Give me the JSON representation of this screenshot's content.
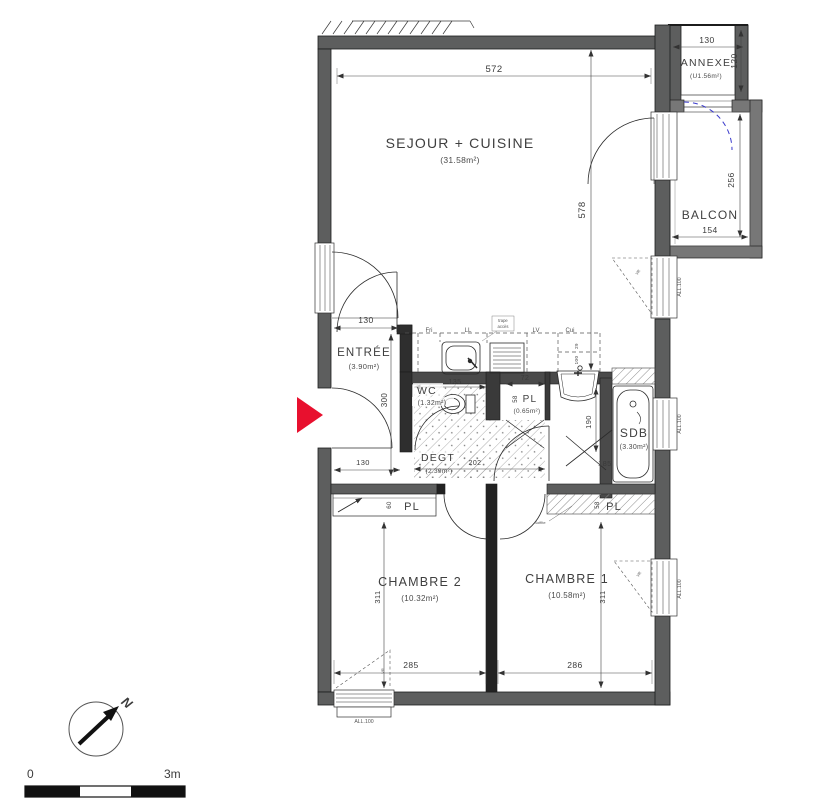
{
  "plan": {
    "rooms": {
      "sejour": {
        "name": "SEJOUR + CUISINE",
        "area": "(31.58m²)"
      },
      "annexe": {
        "name": "ANNEXE",
        "area": "(U1.56m²)"
      },
      "balcon": {
        "name": "BALCON"
      },
      "entree": {
        "name": "ENTRÉE",
        "area": "(3.90m²)"
      },
      "wc": {
        "name": "WC",
        "area": "(1.32m²)"
      },
      "pl_sdb": {
        "name": "PL",
        "area": "(0.65m²)"
      },
      "sdb": {
        "name": "SDB",
        "area": "(3.30m²)"
      },
      "degt": {
        "name": "DEGT",
        "area": "(2.39m²)"
      },
      "pl_ch2": {
        "name": "PL"
      },
      "pl_ch1": {
        "name": "PL"
      },
      "chambre2": {
        "name": "CHAMBRE 2",
        "area": "(10.32m²)"
      },
      "chambre1": {
        "name": "CHAMBRE 1",
        "area": "(10.58m²)"
      }
    },
    "dimensions": {
      "sejour_width": "572",
      "sejour_depth": "578",
      "annexe_width": "130",
      "annexe_depth": "120",
      "balcon_width": "154",
      "balcon_depth": "256",
      "entree_width": "130",
      "entree_depth": "300",
      "wc_width": "135",
      "pl_width": "72",
      "pl_depth": "58",
      "bain_depth": "190",
      "bain_width": "185",
      "degt_width": "202",
      "hall_width": "130",
      "pl_ch2_depth": "60",
      "pl_ch1_depth": "58",
      "chambre2_depth": "311",
      "chambre1_depth": "311",
      "chambre2_width": "285",
      "chambre1_width": "286",
      "cuisine_dim1": "29",
      "cuisine_dim2": "100"
    },
    "kitchen": {
      "fridge": "Fri",
      "washer": "LL",
      "dishwasher": "LV",
      "cooker": "Cui",
      "hatch_line1": "trape",
      "hatch_line2": "accès"
    },
    "labels": {
      "window_sill": "ALL.100",
      "shutter": "VR",
      "soffit": "Soffite"
    },
    "compass": {
      "north": "N"
    },
    "scale_bar": {
      "start": "0",
      "end": "3m"
    }
  },
  "colors": {
    "wall": "#5d5e5e",
    "partition": "#2e2e2e",
    "entry_arrow": "#e8102e",
    "door_dashed": "#3a3acc",
    "line": "#2b2b2b"
  }
}
